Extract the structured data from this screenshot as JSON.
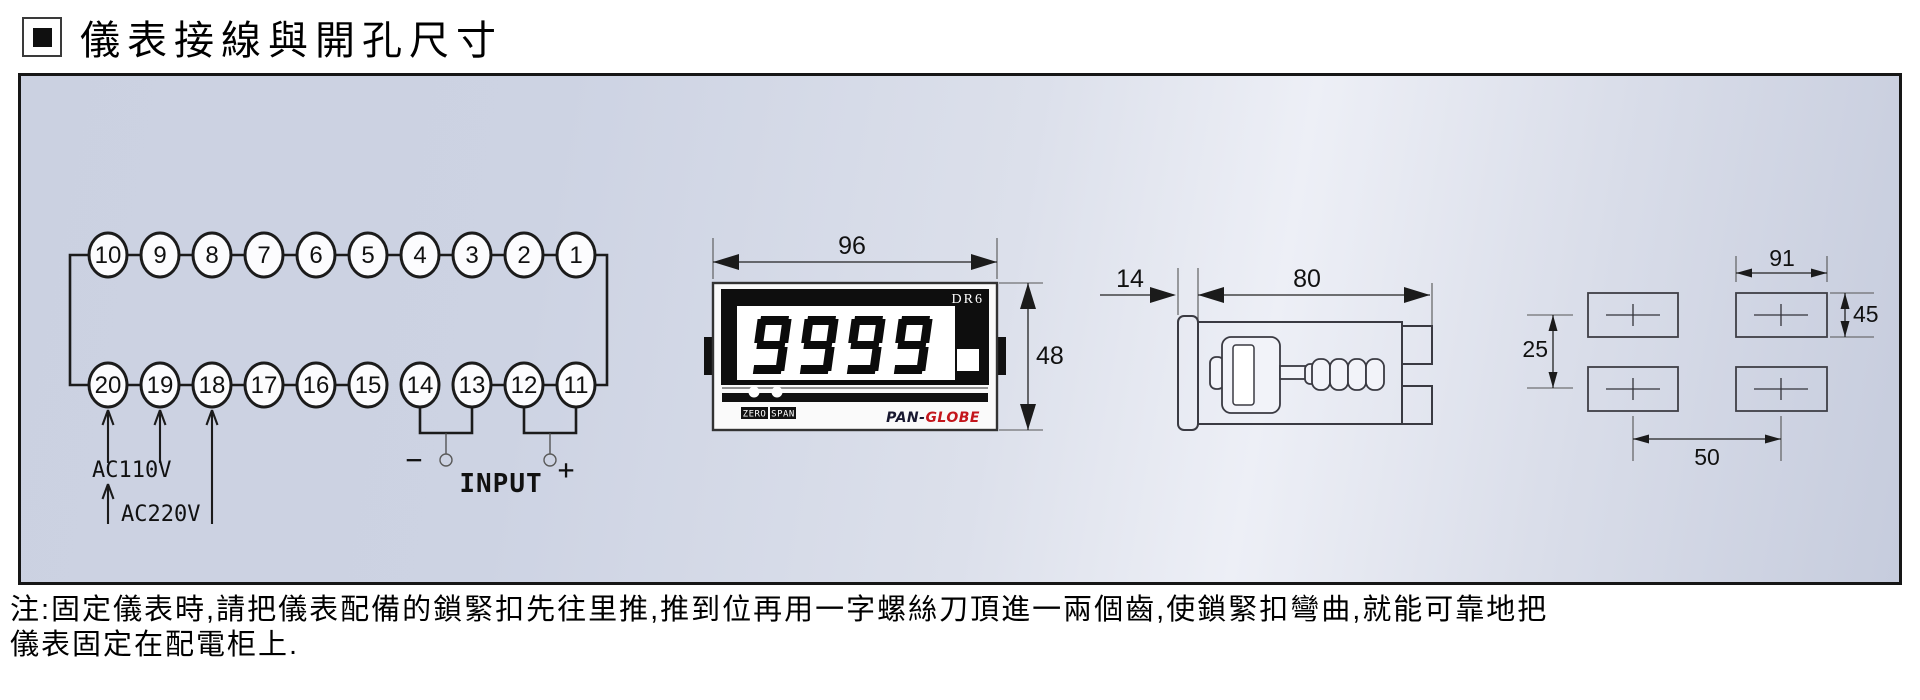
{
  "header": {
    "title": "儀表接線與開孔尺寸"
  },
  "note": "注:固定儀表時,請把儀表配備的鎖緊扣先往里推,推到位再用一字螺絲刀頂進一兩個齒,使鎖緊扣彎曲,就能可靠地把\n儀表固定在配電柜上.",
  "wiring": {
    "top_terminals": [
      "10",
      "9",
      "8",
      "7",
      "6",
      "5",
      "4",
      "3",
      "2",
      "1"
    ],
    "bottom_terminals": [
      "20",
      "19",
      "18",
      "17",
      "16",
      "15",
      "14",
      "13",
      "12",
      "11"
    ],
    "power_110": "AC110V",
    "power_220": "AC220V",
    "input_label": "INPUT",
    "minus": "−",
    "plus": "+"
  },
  "front_view": {
    "display_value": "9999",
    "model": "DR6",
    "buttons": [
      "ZERO",
      "SPAN"
    ],
    "brand_dark": "PAN-",
    "brand_red": "GLOBE",
    "dims": {
      "width": "96",
      "height": "48"
    }
  },
  "side_view": {
    "dims": {
      "bezel_depth": "14",
      "body_depth": "80"
    }
  },
  "cutout": {
    "dims": {
      "width": "91",
      "height": "45",
      "v_spacing": "25",
      "h_spacing": "50"
    }
  },
  "colors": {
    "brand_red": "#c4161c",
    "bezel_black": "#0e0e0e",
    "panel_bg_light": "#eef0f6",
    "panel_bg_dark": "#c6ccdd"
  }
}
